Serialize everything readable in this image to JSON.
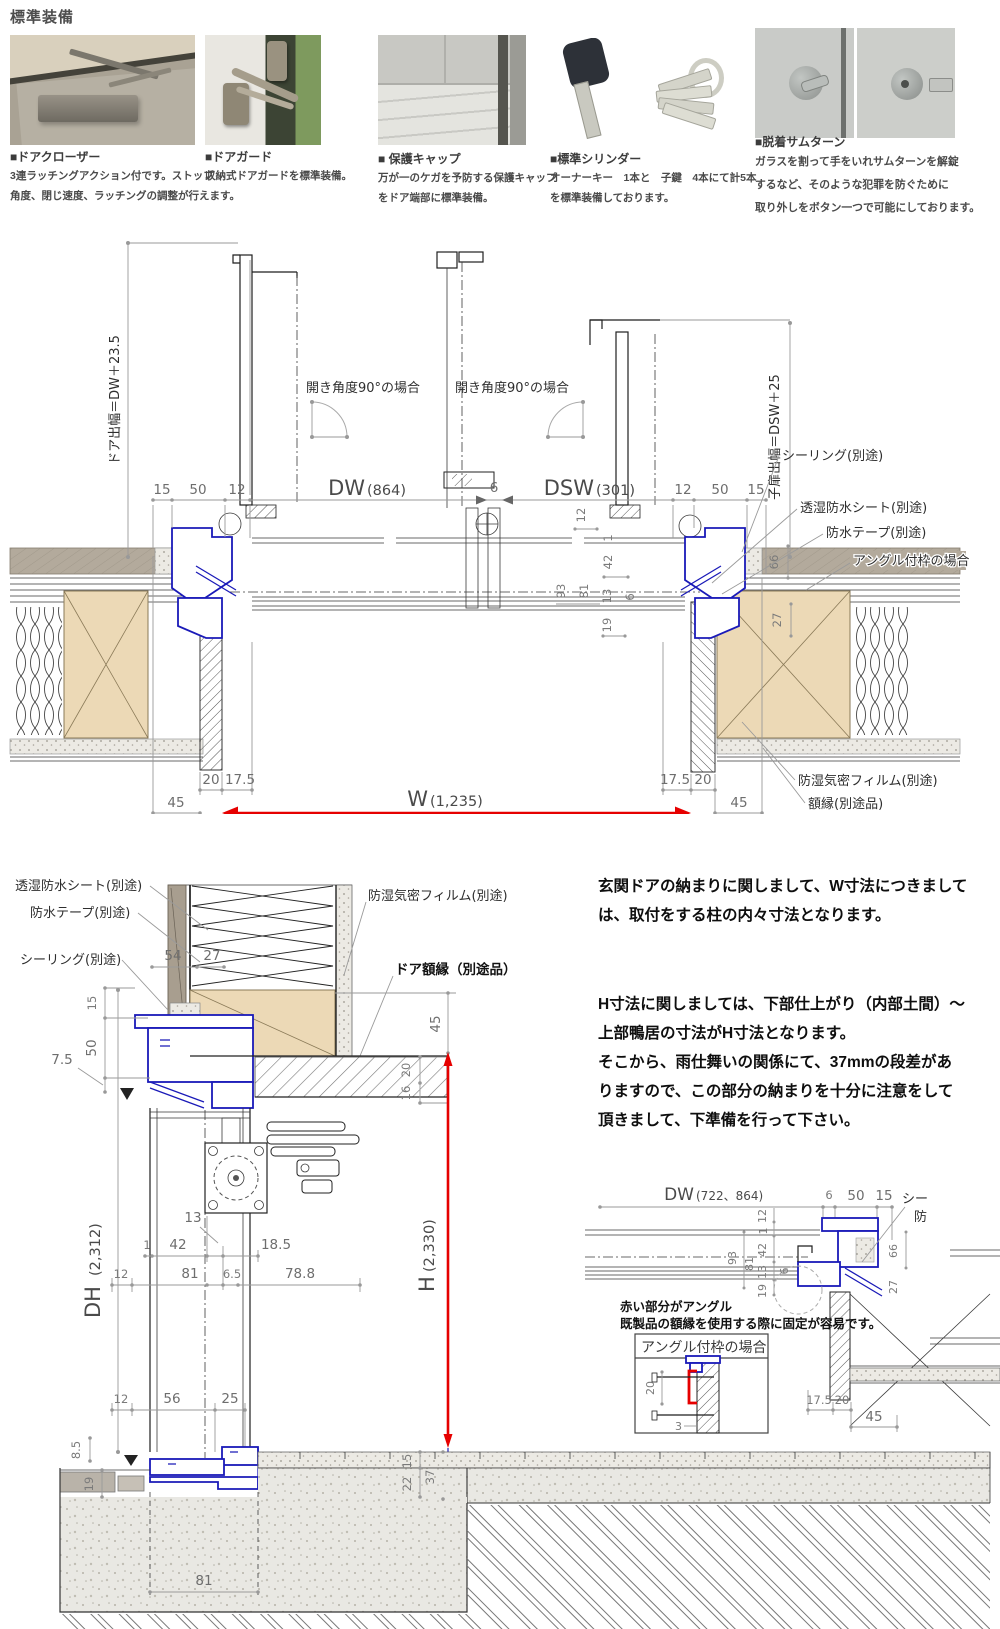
{
  "colors": {
    "frame_blue": "#1a1ab8",
    "dimension_red": "#e60000",
    "wood_fill": "#ecd9b6",
    "siding_gray": "#b3aa9c"
  },
  "header": {
    "title": "標準装備",
    "items": [
      {
        "name": "■ドアクローザー",
        "lines": [
          "3連ラッチングアクション付です。ストップ",
          "角度、閉じ速度、ラッチングの調整が行えます。"
        ]
      },
      {
        "name": "■ドアガード",
        "lines": [
          "収納式ドアガードを標準装備。"
        ]
      },
      {
        "name": "■ 保護キャップ",
        "lines": [
          "万が一のケガを予防する保護キャップ",
          "をドア端部に標準装備。"
        ]
      },
      {
        "name": "■標準シリンダー",
        "lines": [
          "オーナーキー　1本と　子鍵　4本にて計5本",
          "を標準装備しております。"
        ]
      },
      {
        "name": "■脱着サムターン",
        "lines": [
          "ガラスを割って手をいれサムターンを解錠",
          "するなど、そのような犯罪を防ぐために",
          "取り外しをボタン一つで可能にしております。"
        ]
      }
    ]
  },
  "plan": {
    "door_offset_label": "ドア出幅＝DW＋23.5",
    "child_offset_label": "子扉出幅＝DSW＋25",
    "swing_label_left": "開き角度90°の場合",
    "swing_label_right": "開き角度90°の場合",
    "dw": "DW",
    "dw_value": "(864)",
    "dsw": "DSW",
    "dsw_value": "(301)",
    "top_dims": {
      "d15_left": "15",
      "d50_left": "50",
      "d12_left": "12",
      "d6": "6",
      "d12_right": "12",
      "d50_right": "50",
      "d15_right": "15"
    },
    "profile_dims": {
      "d12": "12",
      "d1": "1",
      "d42": "42",
      "d93": "93",
      "d81": "81",
      "d13": "13",
      "d6": "6",
      "d19": "19",
      "d66": "66",
      "d27": "27"
    },
    "labels": {
      "sealing": "シーリング(別途)",
      "moisture_sheet": "透湿防水シート(別途)",
      "waterproof_tape": "防水テープ(別途)",
      "angle_frame_case": "アングル付枠の場合",
      "moisture_film": "防湿気密フィルム(別途)",
      "frame_trim": "額縁(別途品)"
    },
    "bottom_dims": {
      "d20_left": "20",
      "d175_left": "17.5",
      "d45_left": "45",
      "d175_right": "17.5",
      "d20_right": "20",
      "d45_right": "45"
    },
    "w": "W",
    "w_value": "(1,235)"
  },
  "vsec": {
    "labels": {
      "moisture_sheet": "透湿防水シート(別途)",
      "waterproof_tape": "防水テープ(別途)",
      "sealing": "シーリング(別途)",
      "moisture_film": "防湿気密フィルム(別途)",
      "door_trim": "ドア額縁（別途品）"
    },
    "dh": "DH",
    "dh_value": "(2,312)",
    "h": "H",
    "h_value": "(2,330)",
    "dims": {
      "d54": "54",
      "d27": "27",
      "d15_top": "15",
      "d50": "50",
      "d7_5": "7.5",
      "d45": "45",
      "d20": "20",
      "d16": "16",
      "d13": "13",
      "d1": "1",
      "d42": "42",
      "d18_5": "18.5",
      "d12_mid": "12",
      "d81_mid": "81",
      "d6_5": "6.5",
      "d78_8": "78.8",
      "d12_low": "12",
      "d56": "56",
      "d25": "25",
      "d8_5": "8.5",
      "d19": "19",
      "d15_floor": "15",
      "d22": "22",
      "d37": "37",
      "d81_foot": "81"
    }
  },
  "notes": {
    "para1": [
      "玄関ドアの納まりに関しまして、W寸法につきまして",
      "は、取付をする柱の内々寸法となります。"
    ],
    "para2": [
      "H寸法に関しましては、下部仕上がり（内部土間）～",
      "上部鴨居の寸法がH寸法となります。",
      "そこから、雨仕舞いの関係にて、37mmの段差があ",
      "りますので、この部分の納まりを十分に注意をして",
      "頂きまして、下準備を行って下さい。"
    ]
  },
  "detail": {
    "dw": "DW",
    "dw_value": "(722、864)",
    "top_dims": {
      "d6": "6",
      "d50": "50",
      "d15": "15"
    },
    "profile_dims": {
      "d12": "12",
      "d1": "1",
      "d42": "42",
      "d93": "93",
      "d81": "81",
      "d13": "13",
      "d6": "6",
      "d19": "19",
      "d66": "66",
      "d27": "27"
    },
    "note_line1": "赤い部分がアングル",
    "note_line2": "既製品の額縁を使用する際に固定が容易です。",
    "box_title": "アングル付枠の場合",
    "box_dims": {
      "d20": "20",
      "d3": "3"
    },
    "bottom_dims": {
      "d17_5": "17.5",
      "d20": "20",
      "d45": "45"
    },
    "truncated_label_1": "シー",
    "truncated_label_2": "防"
  }
}
